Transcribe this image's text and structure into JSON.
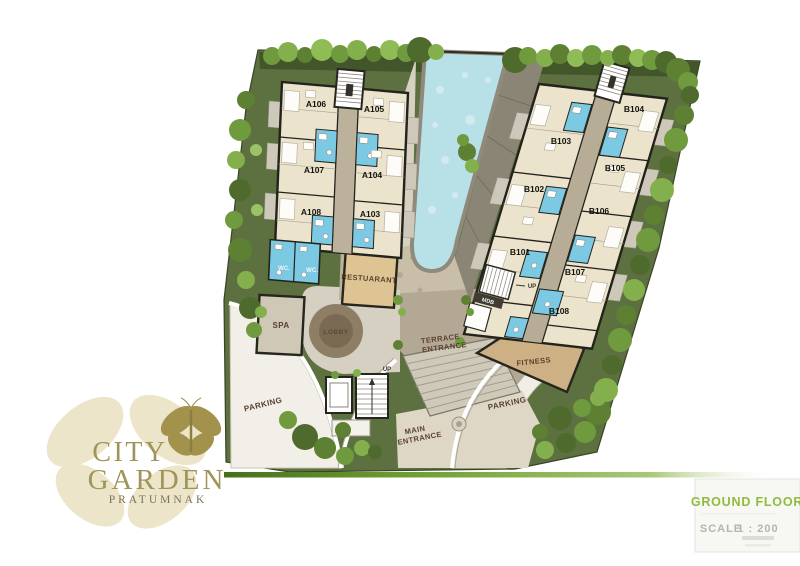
{
  "logo": {
    "title_line1": "CITY",
    "title_line2": "GARDEN",
    "subtitle": "PRATUMNAK"
  },
  "title_block": {
    "floor": "GROUND FLOOR",
    "scale_label": "SCALE",
    "scale_value": "1 : 200"
  },
  "building_a": {
    "units": [
      "A106",
      "A105",
      "A107",
      "A104",
      "A108",
      "A103"
    ],
    "wc_left": "WC.",
    "wc_right": "WC."
  },
  "building_b": {
    "units": [
      "B104",
      "B103",
      "B105",
      "B102",
      "B106",
      "B101",
      "B107",
      "B108"
    ],
    "mdb": "MDB",
    "up": "UP"
  },
  "amenities": {
    "restaurant": "RESTUARANT",
    "spa": "SPA",
    "lobby": "LOBBY",
    "fitness": "FITNESS",
    "terrace_entrance": [
      "TERRACE",
      "ENTRANCE"
    ],
    "main_entrance": [
      "MAIN",
      "ENTRANCE"
    ],
    "parking_west": "PARKING",
    "parking_east": "PARKING",
    "up": "UP"
  },
  "colors": {
    "site_green": "#5c7040",
    "pool_blue": "#b7e0e7",
    "bath_blue": "#7cc9e4",
    "building_fill": "#ebe3cc",
    "accent_green": "#8fbc3e",
    "logo_gold": "#a1945a",
    "label_brown": "#5a4130"
  }
}
